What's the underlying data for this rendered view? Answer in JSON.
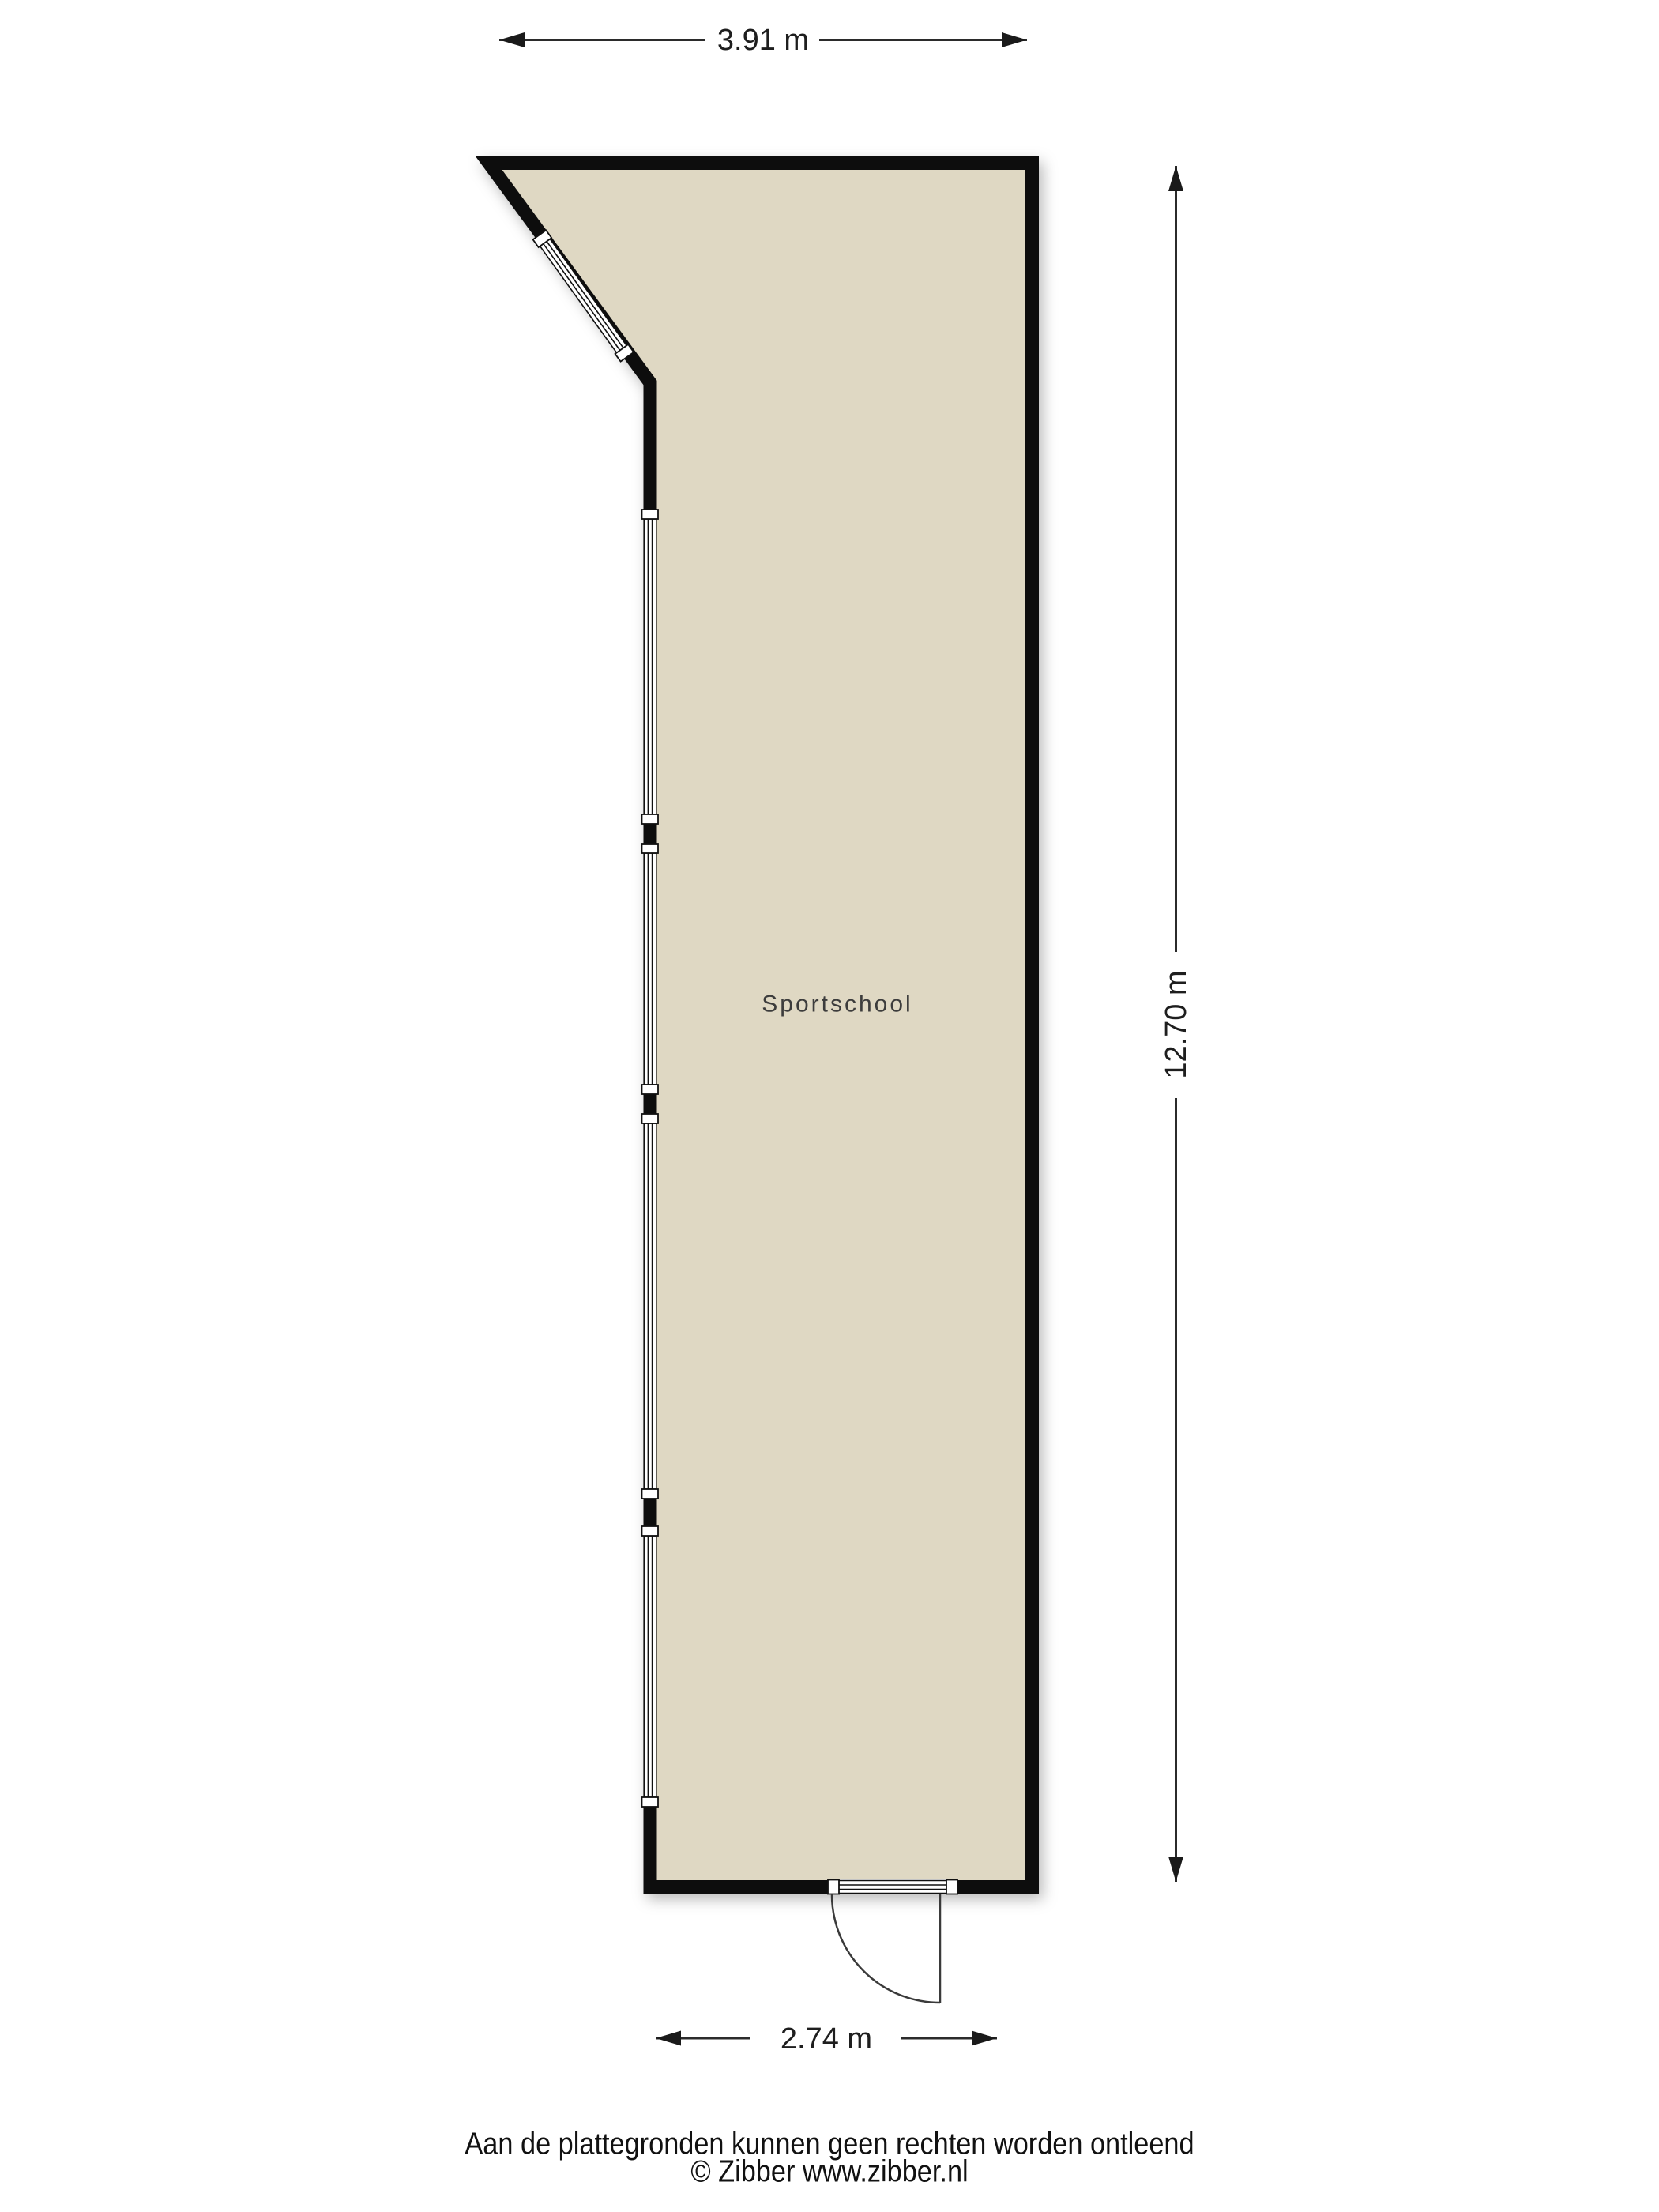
{
  "floorplan": {
    "room_label": "Sportschool",
    "dimensions": {
      "top": "3.91 m",
      "right": "12.70 m",
      "bottom": "2.74 m"
    },
    "footer": {
      "disclaimer": "Aan de plattegronden kunnen geen rechten worden ontleend",
      "copyright": "© Zibber www.zibber.nl"
    },
    "colors": {
      "floor_fill": "#dfd8c3",
      "wall": "#101010",
      "dimension_line": "#2b2b2b",
      "text": "#1e1e1e",
      "background": "#ffffff"
    }
  }
}
